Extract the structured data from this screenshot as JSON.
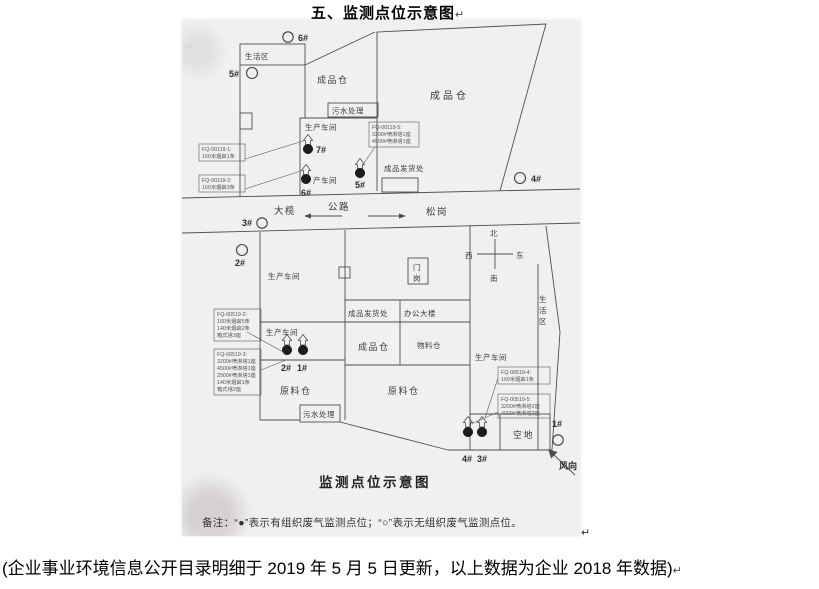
{
  "page": {
    "title": "五、监测点位示意图",
    "title_mark": "↵",
    "image_mark": "↵",
    "footer": "(企业事业环境信息公开目录明细于 2019 年 5 月 5 日更新，以上数据为企业 2018 年数据)"
  },
  "diagram": {
    "caption": "监测点位示意图",
    "note": "备注：“●”表示有组织废气监测点位；“○”表示无组织废气监测点位。",
    "colors": {
      "paper": "#f1eff0",
      "ink": "#4f4d4e"
    },
    "road": {
      "label": "公路",
      "west_label": "大榄",
      "east_label": "松岗"
    },
    "compass": {
      "north": "北",
      "south": "南",
      "west": "西",
      "east": "东"
    },
    "wind_label": "风向",
    "upper_site": {
      "living_area": "生活区",
      "finished_warehouse_left": "成品仓",
      "finished_warehouse_right": "成品仓",
      "sewage_treatment": "污水处理",
      "workshop": "生产车间",
      "workshop_partial": "产车间",
      "shipping": "成品发货处",
      "points": {
        "p7": "7#",
        "p6": "6#",
        "p5": "5#",
        "o6": "6#",
        "o5": "5#",
        "o4": "4#",
        "o3": "3#"
      },
      "callouts": {
        "left1": [
          "FQ-00119-1:",
          "160米烟囱1条"
        ],
        "left2": [
          "FQ-00119-2:",
          "160米烟囱3条"
        ],
        "mid": [
          "FQ-00119-5:",
          "3200#喷淋塔1座",
          "4500#喷淋塔1座"
        ]
      }
    },
    "lower_site": {
      "workshop_nw": "生产车间",
      "workshop_w": "生产车间",
      "workshop_e": "生产车间",
      "shipping": "成品发货处",
      "office": "办公大楼",
      "finished_warehouse": "成品仓",
      "material_warehouse": "物料仓",
      "raw_warehouse_w": "原料仓",
      "raw_warehouse_c": "原料仓",
      "sewage_treatment": "污水处理",
      "living_area_chars": [
        "生",
        "活",
        "区"
      ],
      "gate_chars": [
        "门",
        "岗"
      ],
      "open_land": "空地",
      "points": {
        "p1": "1#",
        "p2": "2#",
        "p3": "3#",
        "p4": "4#",
        "o1": "1#",
        "o2": "2#"
      },
      "callouts": {
        "left1": [
          "FQ-00519-2:",
          "160米烟囱5条",
          "140米烟囱2条",
          "箱式塔3座"
        ],
        "left2": [
          "FQ-00519-3:",
          "3200#喷淋塔1座",
          "4500#喷淋塔1座",
          "2500#喷淋塔1座",
          "140米烟囱1条",
          "箱式塔2座"
        ],
        "right1": [
          "FQ-00519-4:",
          "160米烟囱1条"
        ],
        "right2": [
          "FQ-00519-5:",
          "3200#喷淋塔2座",
          "4000#喷淋塔3座"
        ]
      }
    }
  }
}
